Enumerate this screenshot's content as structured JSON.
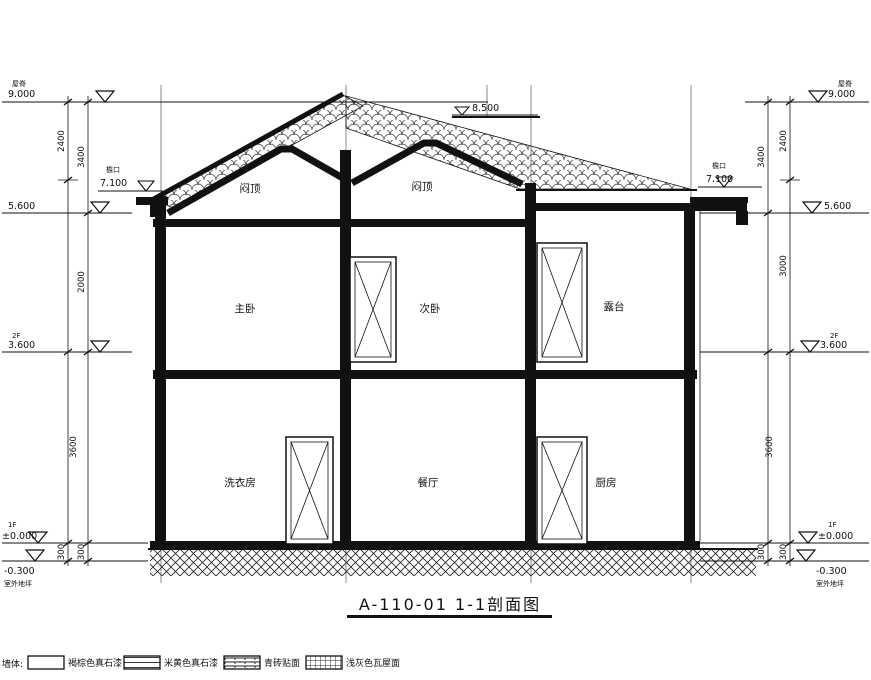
{
  "title": {
    "text": "A-110-01 1-1剖面图"
  },
  "annotations": {
    "secondary_ridge": "8.500"
  },
  "rooms": {
    "attic_left": "闷顶",
    "attic_right": "闷顶",
    "master_bedroom": "主卧",
    "second_bedroom": "次卧",
    "terrace": "露台",
    "laundry": "洗衣房",
    "dining": "餐厅",
    "kitchen": "厨房"
  },
  "levels": {
    "left": {
      "ridge_label": "屋脊",
      "ridge": "9.000",
      "eave_label": "檐口",
      "eave": "7.100",
      "attic": "5.600",
      "f2_label": "2F",
      "f2": "3.600",
      "f1_label": "1F",
      "f1": "±0.000",
      "ground": "-0.300",
      "ground_label": "室外地坪"
    },
    "right": {
      "ridge_label": "屋脊",
      "ridge": "9.000",
      "eave_label": "檐口",
      "eave": "7.100",
      "attic": "5.600",
      "f2_label": "2F",
      "f2": "3.600",
      "f1_label": "1F",
      "f1": "±0.000",
      "ground": "-0.300",
      "ground_label": "室外地坪"
    }
  },
  "dims": {
    "left": {
      "d3400": "3400",
      "d2400": "2400",
      "d2000": "2000",
      "d3600": "3600",
      "d300a": "300",
      "d300b": "300"
    },
    "right": {
      "d3400": "3400",
      "d2400": "2400",
      "d3000": "3000",
      "d3600": "3600",
      "d300a": "300",
      "d300b": "300"
    }
  },
  "legend": {
    "prefix": "墙体:",
    "items": [
      {
        "label": "褐棕色真石漆",
        "swatch": "plain"
      },
      {
        "label": "米黄色真石漆",
        "swatch": "hlines"
      },
      {
        "label": "青砖贴面",
        "swatch": "brick"
      },
      {
        "label": "浅灰色瓦屋面",
        "swatch": "grid"
      }
    ]
  },
  "colors": {
    "ink": "#111111",
    "bg": "#ffffff"
  }
}
